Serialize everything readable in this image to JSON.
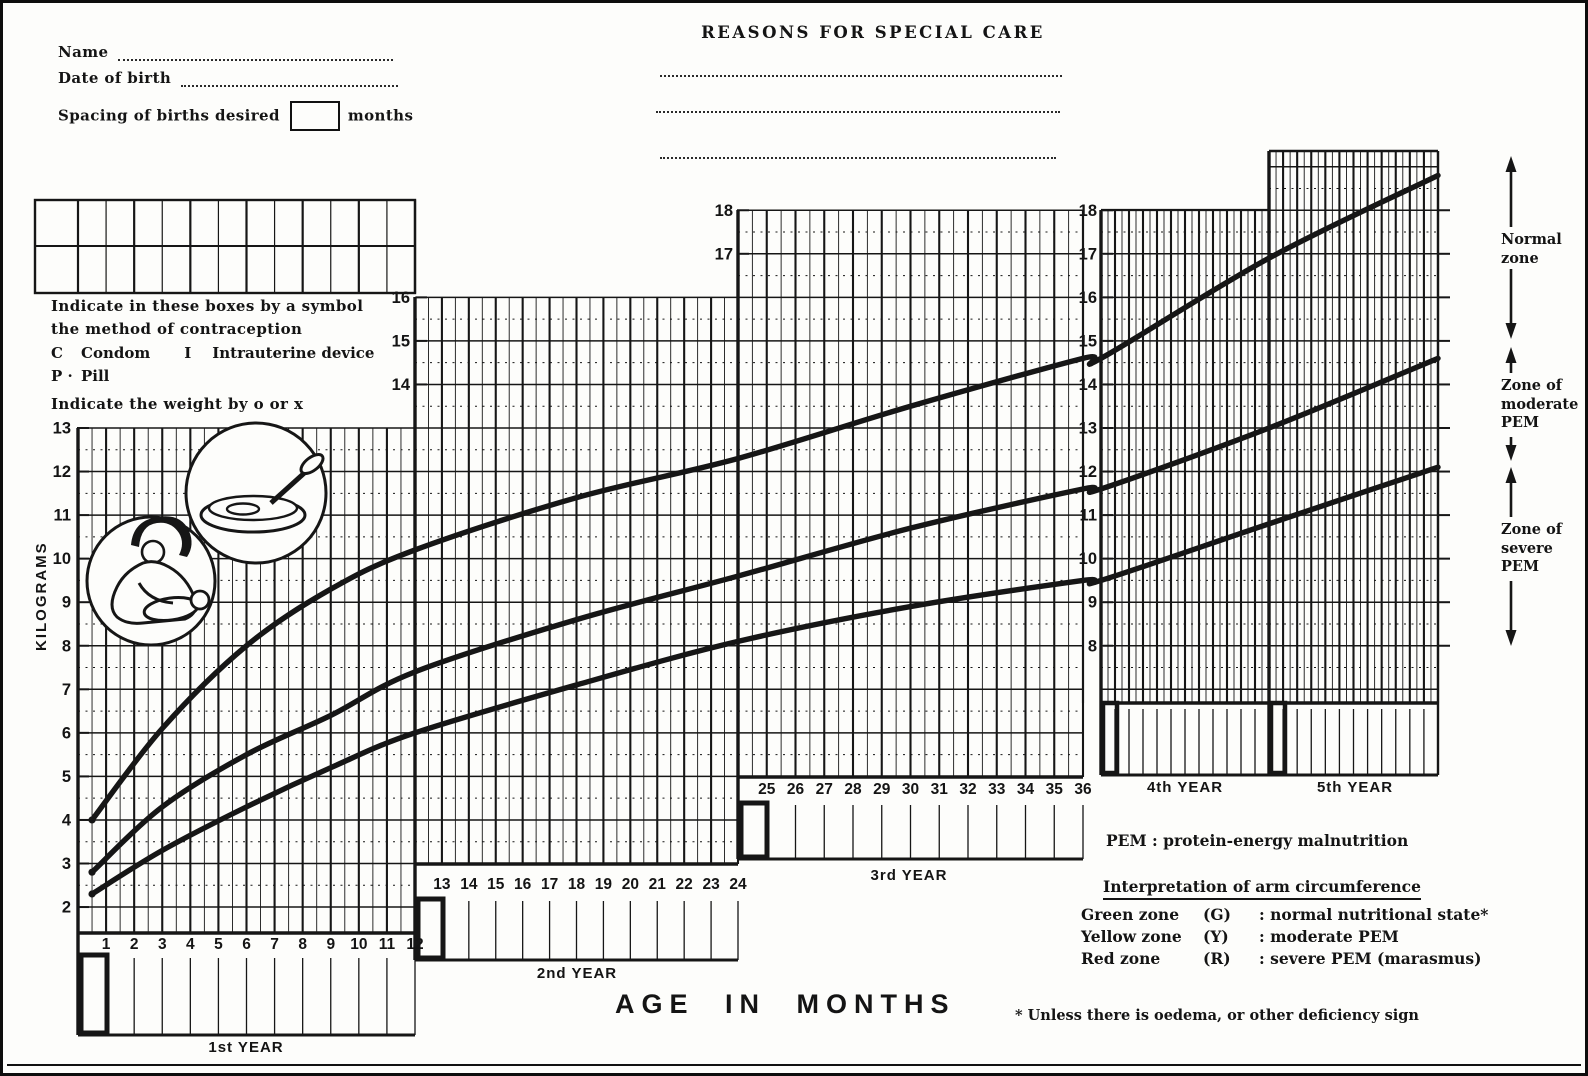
{
  "form": {
    "name_label": "Name",
    "dob_label": "Date of birth",
    "spacing_label": "Spacing of births desired",
    "spacing_value": "",
    "spacing_suffix": "months"
  },
  "reasons": {
    "title": "REASONS FOR SPECIAL CARE"
  },
  "instructions": {
    "boxes": "Indicate in these boxes by a symbol\nthe method of contraception",
    "code_c": "C",
    "code_c_label": "Condom",
    "code_i": "I",
    "code_i_label": "Intrauterine device",
    "code_p": "P ·",
    "code_p_label": "Pill",
    "weight": "Indicate the weight by o or x"
  },
  "axis": {
    "ylabel": "KILOGRAMS",
    "xlabel": "AGE  IN  MONTHS"
  },
  "zones": [
    {
      "label": "Normal\nzone"
    },
    {
      "label": "Zone of\nmoderate\nPEM"
    },
    {
      "label": "Zone of\nsevere\nPEM"
    }
  ],
  "legend": {
    "pem_abbr": "PEM",
    "pem_def": ": protein-energy malnutrition",
    "title": "Interpretation of arm circumference",
    "items": [
      {
        "zone": "Green zone",
        "code": "(G)",
        "meaning": ": normal nutritional state*"
      },
      {
        "zone": "Yellow zone",
        "code": "(Y)",
        "meaning": ": moderate PEM"
      },
      {
        "zone": "Red zone",
        "code": "(R)",
        "meaning": ": severe PEM (marasmus)"
      }
    ],
    "footnote": "* Unless there is oedema,  or other deficiency sign"
  },
  "chart_data": {
    "type": "line",
    "title": "Road-to-health weight-for-age chart, birth to 5 years",
    "xlabel": "AGE IN MONTHS",
    "ylabel": "KILOGRAMS",
    "x_unit": "months",
    "y_unit": "kg",
    "x_range": [
      0,
      60
    ],
    "y_range": [
      2,
      19
    ],
    "grid": true,
    "panels": [
      {
        "label": "1st YEAR",
        "months": [
          1,
          12
        ],
        "kg_labels": [
          13,
          12,
          11,
          10,
          9,
          8,
          7,
          6,
          5,
          4,
          3,
          2
        ],
        "show_month_numbers": true
      },
      {
        "label": "2nd YEAR",
        "months": [
          13,
          24
        ],
        "kg_labels": [
          16,
          15,
          14
        ],
        "show_month_numbers": true
      },
      {
        "label": "3rd YEAR",
        "months": [
          25,
          36
        ],
        "kg_labels": [
          18,
          17
        ],
        "show_month_numbers": true
      },
      {
        "label": "4th YEAR",
        "months": [
          37,
          48
        ],
        "kg_labels": [
          18,
          17,
          16,
          15,
          14,
          13,
          12,
          11,
          10,
          9,
          8
        ],
        "show_month_numbers": false
      },
      {
        "label": "5th YEAR",
        "months": [
          49,
          60
        ],
        "kg_labels": [],
        "show_month_numbers": false
      }
    ],
    "series": [
      {
        "name": "upper reference curve",
        "x": [
          0.5,
          3,
          6,
          9,
          12,
          18,
          24,
          30,
          36,
          48,
          60
        ],
        "y": [
          4.0,
          6.1,
          8.0,
          9.3,
          10.2,
          11.4,
          12.3,
          13.5,
          14.6,
          16.9,
          18.8
        ]
      },
      {
        "name": "middle reference curve",
        "x": [
          0.5,
          3,
          6,
          9,
          12,
          18,
          24,
          30,
          36,
          48,
          60
        ],
        "y": [
          2.8,
          4.3,
          5.5,
          6.4,
          7.4,
          8.6,
          9.6,
          10.7,
          11.6,
          13.0,
          14.6
        ]
      },
      {
        "name": "lower reference curve",
        "x": [
          0.5,
          3,
          6,
          9,
          12,
          18,
          24,
          30,
          36,
          48,
          60
        ],
        "y": [
          2.3,
          3.3,
          4.3,
          5.2,
          6.0,
          7.1,
          8.1,
          8.9,
          9.5,
          10.8,
          12.1
        ]
      }
    ]
  }
}
